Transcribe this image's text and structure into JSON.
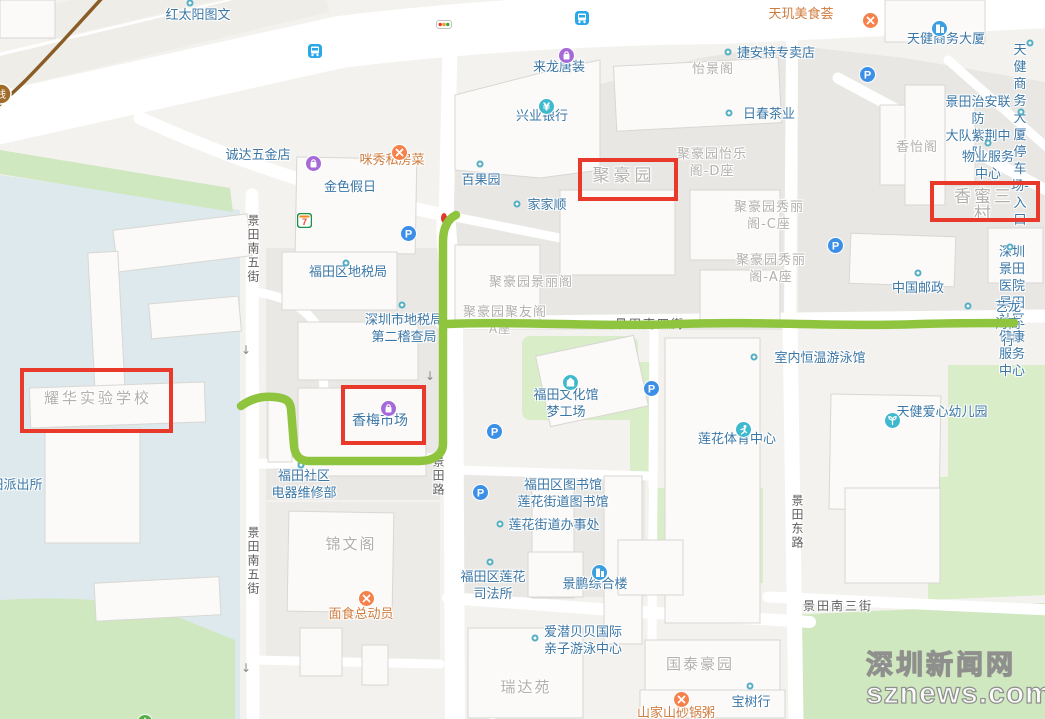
{
  "watermark": {
    "line1": "深圳新闻网",
    "line2": "sznews.com"
  },
  "annotations": {
    "red_box_color": "#e8392b",
    "route_color": "#8fc53e",
    "route_start_tip_color": "#e03a2c",
    "metro_line_color": "#8a5c27",
    "metro_badge_text": "线",
    "boxes": [
      {
        "label": "聚豪园",
        "x": 578,
        "y": 158,
        "w": 92,
        "h": 35
      },
      {
        "label": "香蜜三村",
        "x": 930,
        "y": 181,
        "w": 102,
        "h": 33
      },
      {
        "label": "耀华实验学校",
        "x": 20,
        "y": 368,
        "w": 145,
        "h": 57
      },
      {
        "label": "香梅市场",
        "x": 341,
        "y": 385,
        "w": 77,
        "h": 52
      }
    ]
  },
  "labels": [
    {
      "t": "红太阳图文",
      "x": 198,
      "y": 7,
      "s": "poi"
    },
    {
      "t": "来龙唐装",
      "x": 559,
      "y": 59,
      "s": "poi"
    },
    {
      "t": "捷安特专卖店",
      "x": 776,
      "y": 45,
      "s": "poi"
    },
    {
      "t": "天健商务大厦",
      "x": 946,
      "y": 31,
      "s": "poi"
    },
    {
      "t": "天健商务大厦\n停车场-入口",
      "x": 1020,
      "y": 42,
      "s": "poi"
    },
    {
      "t": "兴业银行",
      "x": 542,
      "y": 108,
      "s": "poi"
    },
    {
      "t": "日春茶业",
      "x": 769,
      "y": 106,
      "s": "poi"
    },
    {
      "t": "景田治安联防\n大队紫荆中队",
      "x": 978,
      "y": 94,
      "s": "poi"
    },
    {
      "t": "物业服务中心",
      "x": 988,
      "y": 149,
      "s": "poi"
    },
    {
      "t": "诚达五金店",
      "x": 258,
      "y": 147,
      "s": "poi"
    },
    {
      "t": "百果园",
      "x": 481,
      "y": 172,
      "s": "poi"
    },
    {
      "t": "金色假日",
      "x": 350,
      "y": 179,
      "s": "poi"
    },
    {
      "t": "家家顺",
      "x": 547,
      "y": 197,
      "s": "poi"
    },
    {
      "t": "中国邮政",
      "x": 918,
      "y": 280,
      "s": "poi"
    },
    {
      "t": "深圳景田医院景田\n社区健康服务中心",
      "x": 1012,
      "y": 244,
      "s": "poi"
    },
    {
      "t": "艺龙海商行",
      "x": 1008,
      "y": 299,
      "s": "poi"
    },
    {
      "t": "福田区地税局",
      "x": 348,
      "y": 264,
      "s": "poi"
    },
    {
      "t": "深圳市地税局\n第二稽查局",
      "x": 404,
      "y": 312,
      "s": "poi"
    },
    {
      "t": "香梅市场",
      "x": 380,
      "y": 413,
      "s": "poi",
      "fs": 14
    },
    {
      "t": "福田文化馆\n梦工场",
      "x": 566,
      "y": 387,
      "s": "poi"
    },
    {
      "t": "室内恒温游泳馆",
      "x": 820,
      "y": 350,
      "s": "poi"
    },
    {
      "t": "莲花体育中心",
      "x": 737,
      "y": 431,
      "s": "poi"
    },
    {
      "t": "天健爱心幼儿园",
      "x": 942,
      "y": 404,
      "s": "poi"
    },
    {
      "t": "福田社区\n电器维修部",
      "x": 304,
      "y": 468,
      "s": "poi"
    },
    {
      "t": "福田区图书馆\n莲花街道图书馆",
      "x": 563,
      "y": 477,
      "s": "poi"
    },
    {
      "t": "莲花街道办事处",
      "x": 554,
      "y": 517,
      "s": "poi"
    },
    {
      "t": "福田区莲花\n司法所",
      "x": 493,
      "y": 569,
      "s": "poi"
    },
    {
      "t": "景鹏综合楼",
      "x": 595,
      "y": 576,
      "s": "poi"
    },
    {
      "t": "爱潜贝贝国际\n亲子游泳中心",
      "x": 583,
      "y": 624,
      "s": "poi"
    },
    {
      "t": "宝树行",
      "x": 751,
      "y": 694,
      "s": "poi"
    },
    {
      "t": "景田派出所",
      "x": 10,
      "y": 477,
      "s": "poi"
    },
    {
      "t": "咪秀私房菜",
      "x": 392,
      "y": 152,
      "s": "food"
    },
    {
      "t": "天玑美食荟",
      "x": 801,
      "y": 6,
      "s": "food"
    },
    {
      "t": "面食总动员",
      "x": 361,
      "y": 606,
      "s": "food"
    },
    {
      "t": "山家山砂锅粥",
      "x": 676,
      "y": 705,
      "s": "food"
    },
    {
      "t": "怡景阁",
      "x": 713,
      "y": 61,
      "s": "area"
    },
    {
      "t": "聚豪园怡乐\n阁-D座",
      "x": 712,
      "y": 146,
      "s": "area"
    },
    {
      "t": "聚豪园秀丽\n阁-C座",
      "x": 769,
      "y": 199,
      "s": "area"
    },
    {
      "t": "聚豪园秀丽\n阁-A座",
      "x": 771,
      "y": 252,
      "s": "area"
    },
    {
      "t": "香怡阁",
      "x": 917,
      "y": 139,
      "s": "area"
    },
    {
      "t": "聚豪园",
      "x": 624,
      "y": 168,
      "s": "area",
      "fs": 17,
      "ls": 4
    },
    {
      "t": "香蜜三村",
      "x": 984,
      "y": 189,
      "s": "area",
      "fs": 17,
      "ls": 3
    },
    {
      "t": "聚豪园景丽阁",
      "x": 531,
      "y": 274,
      "s": "area"
    },
    {
      "t": "聚豪园聚友阁",
      "x": 505,
      "y": 304,
      "s": "area"
    },
    {
      "t": "A座",
      "x": 500,
      "y": 321,
      "s": "area",
      "fs": 12
    },
    {
      "t": "耀华实验学校",
      "x": 98,
      "y": 390,
      "s": "area",
      "fs": 15,
      "ls": 3
    },
    {
      "t": "锦文阁",
      "x": 351,
      "y": 536,
      "s": "area",
      "fs": 15,
      "ls": 2
    },
    {
      "t": "瑞达苑",
      "x": 526,
      "y": 679,
      "s": "area",
      "fs": 15,
      "ls": 2
    },
    {
      "t": "国泰豪园",
      "x": 700,
      "y": 656,
      "s": "area",
      "fs": 15,
      "ls": 2
    },
    {
      "t": "景田南五街",
      "x": 253,
      "y": 214,
      "s": "roadv"
    },
    {
      "t": "景田南五街",
      "x": 253,
      "y": 526,
      "s": "roadv"
    },
    {
      "t": "景田路",
      "x": 438,
      "y": 455,
      "s": "roadv"
    },
    {
      "t": "景田东路",
      "x": 797,
      "y": 494,
      "s": "roadv"
    },
    {
      "t": "景田南三街",
      "x": 838,
      "y": 598,
      "s": "road"
    },
    {
      "t": "景田南四街",
      "x": 650,
      "y": 316,
      "s": "road"
    },
    {
      "t": "↓",
      "x": 246,
      "y": 342,
      "s": "arrow"
    },
    {
      "t": "↓",
      "x": 430,
      "y": 368,
      "s": "arrow"
    },
    {
      "t": "↓",
      "x": 246,
      "y": 660,
      "s": "arrow"
    }
  ],
  "icons": [
    {
      "t": "parking",
      "x": 400,
      "y": 225
    },
    {
      "t": "parking",
      "x": 859,
      "y": 66
    },
    {
      "t": "parking",
      "x": 827,
      "y": 237
    },
    {
      "t": "parking",
      "x": 643,
      "y": 380
    },
    {
      "t": "parking",
      "x": 486,
      "y": 423
    },
    {
      "t": "parking",
      "x": 472,
      "y": 484
    },
    {
      "t": "parking",
      "x": 484,
      "y": 718
    },
    {
      "t": "bus",
      "x": 307,
      "y": 43
    },
    {
      "t": "bus",
      "x": 574,
      "y": 10
    },
    {
      "t": "building",
      "x": 931,
      "y": 20
    },
    {
      "t": "building",
      "x": 591,
      "y": 564
    },
    {
      "t": "shopping",
      "x": 558,
      "y": 47
    },
    {
      "t": "shopping",
      "x": 305,
      "y": 155
    },
    {
      "t": "shopping",
      "x": 380,
      "y": 400
    },
    {
      "t": "restaurant",
      "x": 391,
      "y": 144
    },
    {
      "t": "restaurant",
      "x": 862,
      "y": 12
    },
    {
      "t": "restaurant",
      "x": 358,
      "y": 590
    },
    {
      "t": "restaurant",
      "x": 673,
      "y": 691
    },
    {
      "t": "bank",
      "x": 538,
      "y": 98
    },
    {
      "t": "culture",
      "x": 562,
      "y": 374
    },
    {
      "t": "sport",
      "x": 735,
      "y": 421
    },
    {
      "t": "kindergarten",
      "x": 884,
      "y": 412
    },
    {
      "t": "seven-eleven",
      "x": 297,
      "y": 213
    },
    {
      "t": "tree",
      "x": 137,
      "y": 714
    },
    {
      "t": "traffic-light",
      "x": 436,
      "y": 20
    }
  ],
  "dots": [
    {
      "x": 190,
      "y": 3
    },
    {
      "x": 1030,
      "y": 43
    },
    {
      "x": 728,
      "y": 52
    },
    {
      "x": 729,
      "y": 113
    },
    {
      "x": 1021,
      "y": 112
    },
    {
      "x": 988,
      "y": 143
    },
    {
      "x": 480,
      "y": 164
    },
    {
      "x": 517,
      "y": 204
    },
    {
      "x": 918,
      "y": 273
    },
    {
      "x": 1010,
      "y": 247
    },
    {
      "x": 968,
      "y": 306
    },
    {
      "x": 346,
      "y": 263
    },
    {
      "x": 402,
      "y": 305
    },
    {
      "x": 754,
      "y": 357
    },
    {
      "x": 500,
      "y": 524
    },
    {
      "x": 490,
      "y": 562
    },
    {
      "x": 535,
      "y": 638
    },
    {
      "x": 750,
      "y": 686
    },
    {
      "x": 301,
      "y": 465
    }
  ]
}
